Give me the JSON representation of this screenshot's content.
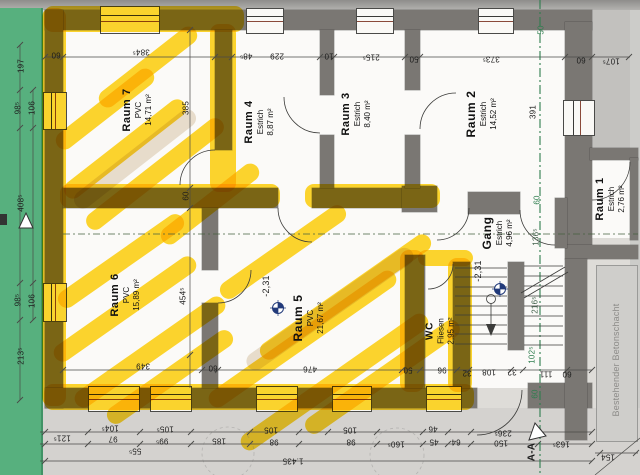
{
  "drawing": {
    "type": "floor-plan-scan",
    "section_label": "A-A",
    "annex_note": "Bestehender Betonschacht",
    "colors": {
      "highlighter": "#ffd000",
      "wall": "#7a7773",
      "green_strip": "#57b07e",
      "section_line": "#2e7d4e",
      "paper": "#dedcd8"
    }
  },
  "rooms": [
    {
      "name": "Raum 7",
      "floor": "PVC",
      "area": "14,71 m²",
      "x": 137,
      "y": 110,
      "ns": 11
    },
    {
      "name": "Raum 4",
      "floor": "Estrich",
      "area": "8,87 m²",
      "x": 259,
      "y": 122,
      "ns": 11
    },
    {
      "name": "Raum 3",
      "floor": "Estrich",
      "area": "8,40 m²",
      "x": 356,
      "y": 114,
      "ns": 11
    },
    {
      "name": "Raum 2",
      "floor": "Estrich",
      "area": "14,52 m²",
      "x": 481,
      "y": 114,
      "ns": 12
    },
    {
      "name": "Raum 6",
      "floor": "PVC",
      "area": "15,89 m²",
      "x": 125,
      "y": 295,
      "ns": 11
    },
    {
      "name": "Raum 5",
      "floor": "PVC",
      "area": "21,67 m²",
      "x": 308,
      "y": 318,
      "ns": 12
    },
    {
      "name": "WC",
      "floor": "Fliesen",
      "area": "2,95 m²",
      "x": 440,
      "y": 331,
      "ns": 10
    },
    {
      "name": "Gang",
      "floor": "Estrich",
      "area": "4,96 m²",
      "x": 497,
      "y": 233,
      "ns": 12
    },
    {
      "name": "Raum 1",
      "floor": "Estrich",
      "area": "2,76 m²",
      "x": 610,
      "y": 199,
      "ns": 11
    }
  ],
  "dims": [
    {
      "t": "60",
      "x": 56,
      "y": 55,
      "r": 180
    },
    {
      "t": "384⁵",
      "x": 141,
      "y": 52,
      "r": 180
    },
    {
      "t": "48⁵",
      "x": 246,
      "y": 56,
      "r": 180
    },
    {
      "t": "229",
      "x": 277,
      "y": 56,
      "r": 180
    },
    {
      "t": "10",
      "x": 329,
      "y": 56,
      "r": 180
    },
    {
      "t": "215⁵",
      "x": 371,
      "y": 57,
      "r": 180
    },
    {
      "t": "50",
      "x": 414,
      "y": 59,
      "r": 180
    },
    {
      "t": "373⁵",
      "x": 491,
      "y": 59,
      "r": 180
    },
    {
      "t": "60",
      "x": 581,
      "y": 60,
      "r": 180
    },
    {
      "t": "107⁵",
      "x": 611,
      "y": 61,
      "r": 180
    },
    {
      "t": "50",
      "x": 541,
      "y": 30,
      "r": -90,
      "c": "g"
    },
    {
      "t": "197",
      "x": 21,
      "y": 66,
      "r": -90
    },
    {
      "t": "98⁵",
      "x": 18,
      "y": 108,
      "r": -90
    },
    {
      "t": "106",
      "x": 32,
      "y": 108,
      "r": -90
    },
    {
      "t": "408⁵",
      "x": 21,
      "y": 203,
      "r": -90
    },
    {
      "t": "98⁵",
      "x": 18,
      "y": 300,
      "r": -90
    },
    {
      "t": "106",
      "x": 32,
      "y": 301,
      "r": -90
    },
    {
      "t": "213⁵",
      "x": 21,
      "y": 356,
      "r": -90
    },
    {
      "t": "385",
      "x": 186,
      "y": 108,
      "r": -90
    },
    {
      "t": "60",
      "x": 186,
      "y": 196,
      "r": -90
    },
    {
      "t": "454⁵",
      "x": 183,
      "y": 296,
      "r": -90
    },
    {
      "t": "391",
      "x": 533,
      "y": 112,
      "r": -90
    },
    {
      "t": "60",
      "x": 537,
      "y": 200,
      "r": -90,
      "c": "g"
    },
    {
      "t": "136⁵",
      "x": 536,
      "y": 237,
      "r": -90,
      "c": "dg"
    },
    {
      "t": "216⁵",
      "x": 535,
      "y": 305,
      "r": -90,
      "c": "dg"
    },
    {
      "t": "102⁵",
      "x": 532,
      "y": 355,
      "r": -90,
      "c": "g"
    },
    {
      "t": "60",
      "x": 535,
      "y": 394,
      "r": -90,
      "c": "g"
    },
    {
      "t": "349",
      "x": 143,
      "y": 366,
      "r": 180
    },
    {
      "t": "60",
      "x": 213,
      "y": 368,
      "r": 180
    },
    {
      "t": "476",
      "x": 310,
      "y": 369,
      "r": 180
    },
    {
      "t": "50",
      "x": 408,
      "y": 370,
      "r": 180
    },
    {
      "t": "96",
      "x": 442,
      "y": 370,
      "r": 180
    },
    {
      "t": "32",
      "x": 467,
      "y": 373,
      "r": 180
    },
    {
      "t": "108",
      "x": 489,
      "y": 372,
      "r": 180
    },
    {
      "t": "32",
      "x": 512,
      "y": 372,
      "r": 180
    },
    {
      "t": "111",
      "x": 546,
      "y": 374,
      "r": 180
    },
    {
      "t": "60",
      "x": 567,
      "y": 374,
      "r": 180
    },
    {
      "t": "104⁵",
      "x": 110,
      "y": 428,
      "r": 180
    },
    {
      "t": "105⁵",
      "x": 165,
      "y": 429,
      "r": 180
    },
    {
      "t": "105",
      "x": 271,
      "y": 430,
      "r": 180
    },
    {
      "t": "105",
      "x": 350,
      "y": 430,
      "r": 180
    },
    {
      "t": "46",
      "x": 433,
      "y": 429,
      "r": 180
    },
    {
      "t": "236⁵",
      "x": 503,
      "y": 433,
      "r": 180
    },
    {
      "t": "121⁵",
      "x": 62,
      "y": 438,
      "r": 180
    },
    {
      "t": "97",
      "x": 113,
      "y": 439,
      "r": 180
    },
    {
      "t": "99⁵",
      "x": 162,
      "y": 441,
      "r": 180
    },
    {
      "t": "185",
      "x": 219,
      "y": 441,
      "r": 180
    },
    {
      "t": "98",
      "x": 274,
      "y": 442,
      "r": 180
    },
    {
      "t": "98",
      "x": 351,
      "y": 442,
      "r": 180
    },
    {
      "t": "160⁵",
      "x": 396,
      "y": 444,
      "r": 180
    },
    {
      "t": "45",
      "x": 434,
      "y": 442,
      "r": 180
    },
    {
      "t": "64",
      "x": 456,
      "y": 442,
      "r": 180
    },
    {
      "t": "150",
      "x": 501,
      "y": 443,
      "r": 180
    },
    {
      "t": "163⁵",
      "x": 561,
      "y": 444,
      "r": 180
    },
    {
      "t": "55⁵",
      "x": 135,
      "y": 451,
      "r": 180
    },
    {
      "t": "1.435",
      "x": 293,
      "y": 461,
      "r": 180
    },
    {
      "t": "154",
      "x": 608,
      "y": 457,
      "r": 180
    },
    {
      "t": "-2,31",
      "x": 266,
      "y": 286,
      "r": -90,
      "s": 9
    },
    {
      "t": "-2,31",
      "x": 478,
      "y": 271,
      "r": -90,
      "s": 9
    },
    {
      "t": "A-A",
      "x": 532,
      "y": 452,
      "r": -90,
      "s": 10,
      "b": 1
    },
    {
      "t": "Bestehender Betonschacht",
      "x": 616,
      "y": 360,
      "r": -90,
      "s": 9,
      "c": "gray"
    }
  ]
}
